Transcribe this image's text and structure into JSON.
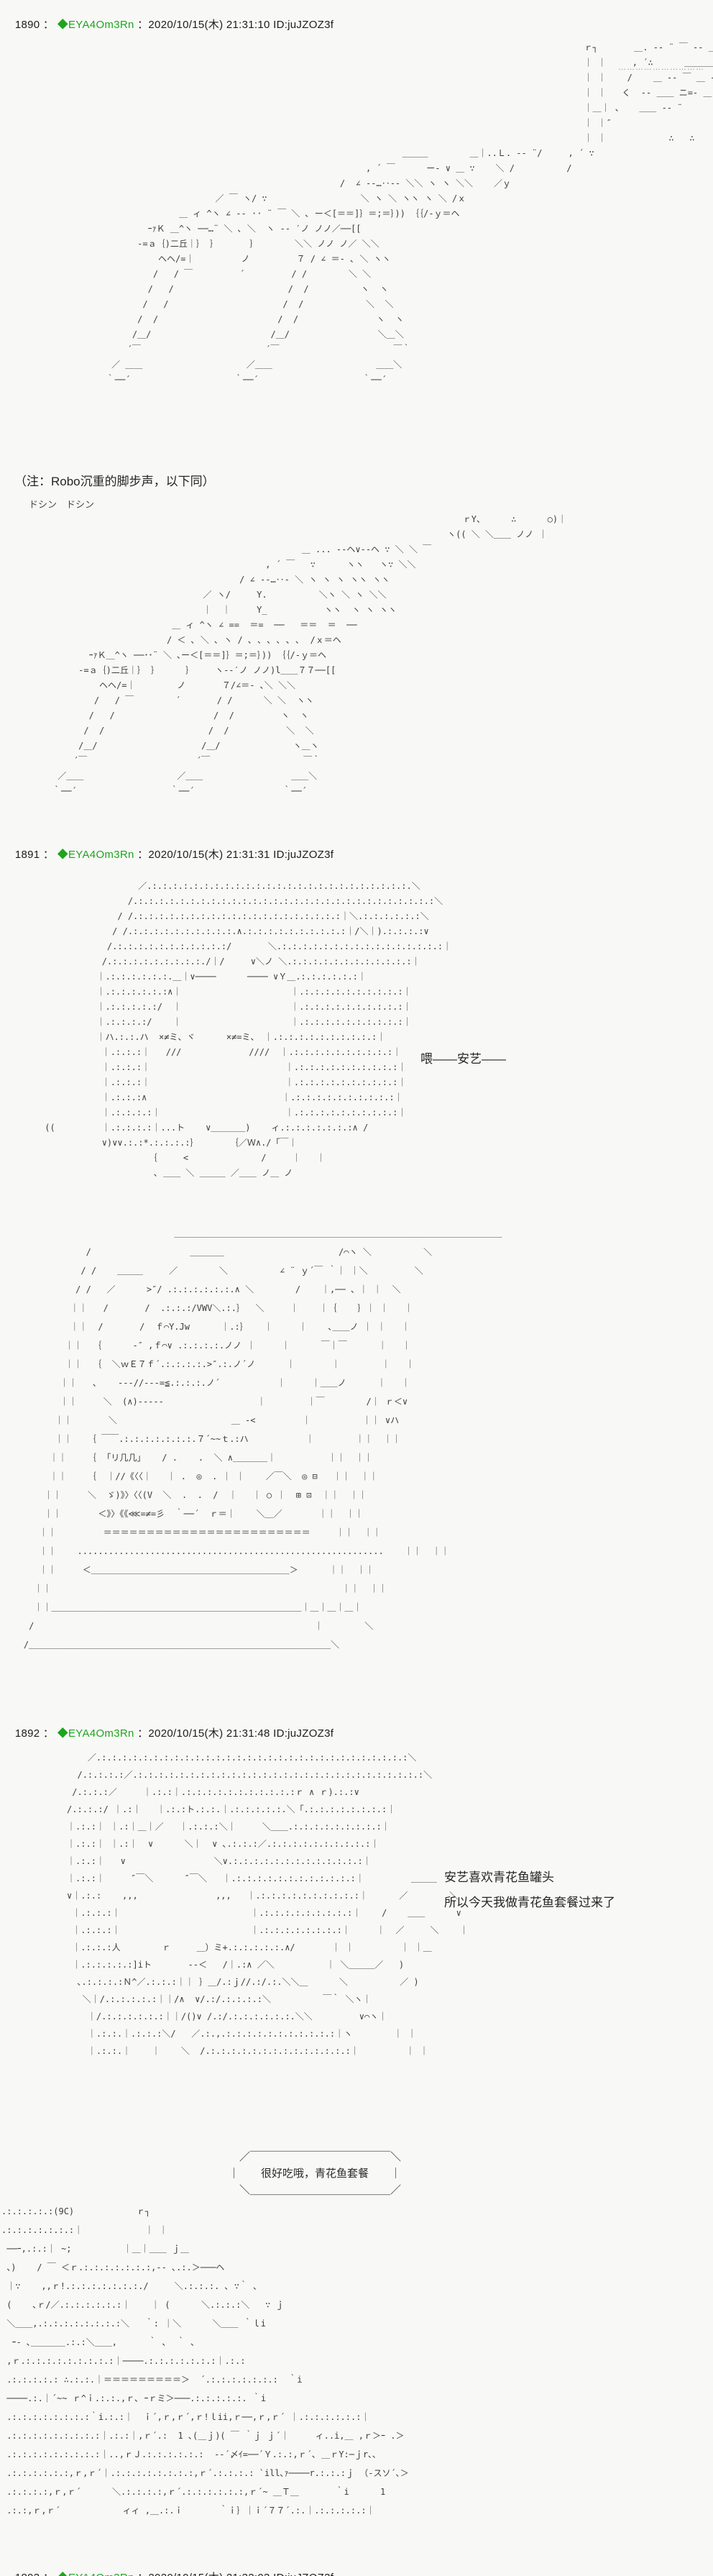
{
  "page": {
    "background": "#f8f8f6",
    "aa_color": "#3d3d3d",
    "tripcode_color": "#1ea51e"
  },
  "top_dots": "…………………………",
  "posts": [
    {
      "number": "1890",
      "sep": " ： ",
      "tripcode": "◆EYA4Om3Rn",
      "meta": " ：2020/10/15(木) 21:31:10 ID:juJZOZ3f",
      "note": "（注：Robo沉重的脚步声，以下同）",
      "sfx": "ドシン　ドシン",
      "aa_robot_1": "                                                                                                    ｒ┐       ＿. -‐ ¨ ￣ ‐- ＿\n                                                                                                    ｜ ｜     , ´∴      ＿＿＿＿\n                                                                                                    ｜ ｜    /    ＿ -‐ ￣ ＿ --\n                                                                                                    ｜ ｜   く  -- ＿＿ ニ=- ＿\n                                                                                                    ｜＿｜ 、   ＿＿ -- ¨\n                                                                                                    ｜ ｜″\n                                                                                                    ｜ ｜            ∴   ∴\n                                                                 ＿＿＿        ＿｜..Ｌ. -‐ ¨/     , ´ ∵\n                                                          , ´ ￣      ー- ∨ ＿ ∵    ＼ /          /\n                                                     /  ∠ -‐…‥‐- ＼＼ ヽ ヽ ＼＼    ／ｙ\n                             ／ ￣ ヽ/ ∵                  ＼ ヽ ＼ ヽヽ ヽ ＼ /ｘ\n                      ＿ ィ ^ヽ ∠ -‐ ·· ¨ ￣ ＼ ､ ー＜[＝＝]｝＝;＝｝)) ｛｛/‐ｙ＝ヘ\n                ｰｧＫ ＿^ヽ ──…¨ ＼ ､ ＼  ヽ -- ′ノ ノノ／──[[\n              ‐=ａ｛)二丘｜｝ ｝      ｝       ＼＼ ノノ ノ／ ＼＼\n                  ヘヘ/=｜         ノ         ７ / ∠ ＝- ､ ＼ ヽヽ\n                 /   / ￣         ´         / /        ＼ ＼\n                /   /                      /  /          ヽ  ヽ\n               /   /                      /  /            ＼  ＼\n              /  /                       /  /               ヽ  ヽ\n             /＿/                       /＿/                 ＼＿＼\n            ´￣                        ´￣                      ￣｀\n         ／ ＿＿                    ／＿＿                    ＿＿＼\n        ｀──´                    ｀──´                    ｀──´",
      "aa_robot_2": "                                                                                        ｒY、     ∴      ○)｜\n                                                                                     ヽ(( ＼ ＼＿＿ ノノ ｜\n                                                         ＿ ... -‐ヘ∨--ヘ ∵ ＼ ＼ ￣\n                                                  , ´ ￣   ∵      ヽヽ   ヽ∵ ＼＼\n                                             / ∠ -‐…‥- ＼ ヽ ヽ ヽ ヽヽ ヽヽ\n                                      ／ ヽ/     Y.          ＼ヽ ＼ ヽ ＼＼\n                                      ｜  ｜     Y_           ヽヽ  ヽ ヽ ヽヽ\n                                ＿ ィ ^ヽ ∠ ==  ＝=  ──   ＝＝  ＝  ──\n                               / ＜ ､ ＼ ､ ヽ / ､ ､ ､ ､ ､ ､  /ｘ＝ヘ\n                ｰｧＫ＿^ヽ ──･･¨ ＼ ､ー＜[＝＝]｝＝;＝｝)) ｛｛/‐ｙ＝ヘ\n              ‐=ａ｛)二丘｜｝ ｝     ｝    ヽ--′ノ ノノ)l＿＿７７──[[\n                  ヘヘ/=｜        ノ       ７/∠＝- ､＼ ＼＼\n                 /   / ￣        ´       / /      ＼ ＼  ヽヽ\n                /   /                   /  /         ヽ  ヽ\n               /  /                    /  /           ＼  ＼\n              /＿/                    /＿/              ヽ＿ヽ\n             ´￣                     ´￣                  ￣｀\n          ／＿＿                  ／＿＿                 ＿＿＼\n         ｀──´                  ｀──´                 ｀──´"
    },
    {
      "number": "1891",
      "sep": " ： ",
      "tripcode": "◆EYA4Om3Rn",
      "meta": " ：2020/10/15(木) 21:31:31 ID:juJZOZ3f",
      "dialog": "喂——安艺——",
      "aa_face": "                   ／.:.:.:.:.:.:.:.:.:.:.:.:.:.:.:.:.:.:.:.:.:.:.:.:.:.＼\n                 /.:.:.:.:.:.:.:.:.:.:.:.:.:.:.:.:.:.:.:.:.:.:.:.:.:.:.:.:.:＼\n               / /.:.:.:.:.:.:.:.:.:.:.:.:.:.:.:.:.:.:.:.:｜＼.:.:.:.:.:.:＼\n              / /.:.:.:.:.:.:.:.:.:.:.∧.:.:.:.:.:.:.:.:.:.:｜/＼｜).:.:.:.:∨\n             /.:.:.:.:.:.:.:.:.:.:.:/       ＼.:.:.:.:.:.:.:.:.:.:.:.:.:.:.:.:｜\n            /.:.:.:.:.:.:.:.:.:./｜/     ∨＼ノ ＼.:.:.:.:.:.:.:.:.:.:.:.:｜\n           ｜.:.:.:.:.:.:.＿｜∨────      ──── ∨Ｙ＿.:.:.:.:.:.:｜\n           ｜.:.:.:.:.:.:∧｜                     ｜.:.:.:.:.:.:.:.:.:.:｜\n           ｜.:.:.:.:.:/  ｜                     ｜.:.:.:.:.:.:.:.:.:.:｜\n           ｜.:.:.:.:/    ｜                     ｜.:.:.:.:.:.:.:.:.:.:｜\n           ｜ハ.:.:.ハ  ×≠ミ、ヾ      ×≠=ミ、 ｜.:.:.:.:.:.:.:.:.:.:｜\n            ｜.:.:.:｜   ///             ////  ｜.:.:.:.:.:.:.:.:.:.:｜\n            ｜.:.:.:｜                          ｜.:.:.:.:.:.:.:.:.:.:｜\n            ｜.:.:.:｜                          ｜.:.:.:.:.:.:.:.:.:.:｜\n            ｜.:.:.:∧                          ｜.:.:.:.:.:.:.:.:.:.:｜\n            ｜.:.:.:.:｜                        ｜.:.:.:.:.:.:.:.:.:.:｜\n ((         ｜.:.:.:.:｜...ト    ∨＿＿＿＿)    ィ.:.:.:.:.:.:.:∧ /\n            ∨)∨∨.:.:*.:.:.:.:｝      ｛／Ｗ∧./「￣｜\n                     ｛     <              /     ｜   ｜\n                      ､ ＿＿ ＼ ＿＿＿ ／＿＿ ノ＿ ノ",
      "aa_cockpit": "                                 ＿＿＿＿＿＿＿＿＿＿＿＿＿＿＿＿＿＿＿＿＿＿＿＿＿＿＿＿＿＿＿＿＿＿＿＿＿＿\n                /                   ＿＿＿＿                      /⌒ヽ ＼          ＼\n               / /    ＿＿＿     ／        ＼          ∠ ¨ ｙ´￣ ｀｜ ｜＼         ＼\n              / /   ／      >″/ .:.:.:.:.:.:.∧ ＼        /    ｜,── 、｜ ｜  ＼\n             ｜｜   /       /  .:.:.:/VWV＼.:.｝  ＼     ｜    ｜｛    ｝｜ ｜   ｜\n             ｜｜  /       /  ｆ⌒Y.Jw      ｜.:｝   ｜     ｜    ､＿＿ノ ｜ ｜   ｜\n            ｜｜  ｛      -″ ,ｆ⌒∨ .:.:.:.:.ノノ ｜     ｜      ￣｜￣      ｜   ｜\n            ｜｜  ｛  ＼ｗＥ７ｆ´.:.:.:.:.>″.:.ノ´ノ      ｜       ｜        ｜   ｜\n           ｜｜   ､    ---//---=≦.:.:.:.ノ´           ｜     ｜＿＿ノ      ｜   ｜\n           ｜｜     ＼  (∧)-----                  ｜        ｜￣        /｜ ｒ＜∨\n          ｜｜       ＼                      ＿ -<         ｜          ｜｜ ∨ハ\n          ｜｜   ｛ ￣￣.:.:.:.:.:.:.:.７´~~ｔ.:ハ           ｜        ｜｜  ｜｜\n         ｜｜    ｛  ｢リ几几｣    / .    .  ＼ ∧＿＿＿＿｜          ｜｜  ｜｜\n         ｜｜    ｛  ｜//《〈〈｜   ｜ .  ◎  . ｜ ｜    ／￣＼  ◎ ⊟   ｜｜  ｜｜\n        ｜｜     ＼  ゞ)》〉〈〈(V  ＼  .  .  /  ｜   ｜ ○ ｜  ⊞ ⊡  ｜｜  ｜｜\n        ｜｜       ＜》〉《《⋘=≠=彡  ｀──´  ｒ＝｜    ＼＿／       ｜｜  ｜｜\n       ｜｜         ＝＝＝＝＝＝＝＝＝＝＝＝＝＝＝＝＝＝＝＝＝＝＝＝     ｜｜  ｜｜\n       ｜｜    ...........................................................    ｜｜  ｜｜\n       ｜｜     ＜＿＿＿＿＿＿＿＿＿＿＿＿＿＿＿＿＿＿＿＿＿＿＿＞      ｜｜  ｜｜\n      ｜｜                                                        ｜｜  ｜｜\n      ｜｜＿＿＿＿＿＿＿＿＿＿＿＿＿＿＿＿＿＿＿＿＿＿＿＿＿＿＿＿＿｜＿｜＿｜＿｜\n     /                                                      ｜        ＼\n    /＿＿＿＿＿＿＿＿＿＿＿＿＿＿＿＿＿＿＿＿＿＿＿＿＿＿＿＿＿＿＿＿＿＿＿＼"
    },
    {
      "number": "1892",
      "sep": " ： ",
      "tripcode": "◆EYA4Om3Rn",
      "meta": " ：2020/10/15(木) 21:31:48 ID:juJZOZ3f",
      "dialog_line1": "安艺喜欢青花鱼罐头",
      "dialog_line2": "所以今天我做青花鱼套餐过来了",
      "speech_box_text": "很好吃哦，青花鱼套餐",
      "speech_box": "　／￣￣￣￣￣￣￣￣￣￣￣￣￣＼\n｜　　很好吃哦，青花鱼套餐　　｜\n　＼＿＿＿＿＿＿＿＿＿＿＿＿＿／",
      "aa_face": "             ／.:.:.:.:.:.:.:.:.:.:.:.:.:.:.:.:.:.:.:.:.:.:.:.:.:.:.:.:.:.:＼\n           /.:.:.:.:／.:.:.:.:.:.:.:.:.:.:.:.:.:.:.:.:.:.:.:.:.:.:.:.:.:.:.:.:＼\n          /.:.:.:／     ｜.:.:｜.:.:.:.:.:.:.:.:.:.:.:ｒ ∧ ｒ).:.:∨\n         /.:.:.:/ ｜.:｜   ｜.:.:ト.:.:.｜.:.:.:.:.:.＼「.:.:.:.:.:.:.:.:｜\n         ｜.:.:｜ ｜.:｜＿｜／   ｜.:.:.:＼｜     ＼＿＿.:.:.:.:.:.:.:.:.:｜\n         ｜.:.:｜ ｜.:｜  ∨      ＼｜  ∨ ､.:.:.:／.:.:.:.:.:.:.:.:.:.:｜\n         ｜.:.:｜   ∨                 ＼∨.:.:.:.:.:.:.:.:.:.:.:.:.:｜\n         ｜.:.:｜     ″￣＼      ″￣＼   ｜.:.:.:.:.:.:.:.:.:.:.:.:｜         ＿＿＿\n         ∨｜.:.:    ,,,               ,,,   ｜.:.:.:.:.:.:.:.:.:.:｜      ／        ＼\n          ｜.:.:.:｜                         ｜.:.:.:.:.:.:.:.:.:｜    /    ＿＿      ∨\n          ｜.:.:.:｜                         ｜.:.:.:.:.:.:.:.:｜     ｜  ／     ＼    ｜\n          ｜.:.:.:人        ｒ     ＿）ミ+.:.:.:.:.:.∧/       ｜ ｜         ｜ ｜＿\n          ｜.:.:.:.:.:]iト       --＜   /｜.:∧ ／＼          ｜ ＼＿＿＿／   )\n           ､.:.:.:.:Ｎ^／.:.:.:｜｜ ｝＿/.:ｊ//.:/.:.＼＼＿      ＼          ／ )\n            ＼｜/.:.:.:.:.:｜｜/∧  ∨/.:/.:.:.:.:＼          ￣｀ ＼ヽ｜\n             ｜/.:.:.:.:.:.:｜｜/()∨ /.:/.:.:.:.:.:.:.＼＼         ∨⌒ヽ｜\n             ｜.:.:.｜.:.:.:＼/   ／.:.,.:.:.:.:.:.:.:.:.:.:.:｜ヽ        ｜ ｜\n             ｜.:.:.｜    ｜    ＼  /.:.:.:.:.:.:.:.:.:.:.:.:.:.:｜         ｜ ｜",
      "aa_mecha": ".:.:.:.:.:(9C)            ｒ┐\n.:.:.:.:.:.:.:｜            ｜ ｜\n ──ｰ,.:.:｜ ~;          ｜＿｜＿＿ ｊ＿\n 、)    / ￣ ＜ｒ.:.:.:.:.:.:.:,-- ､.:.＞───ヘ\n ｜∵    ,,ｒ!.:.:.:.:.:.:.:./     ＼.:.:.:. ､ ∵｀ ､\n (    ､ｒ/／.:.:.:.:.:.:｜    ｜ (      ＼.:.:.:＼   ∵ ｊ\n ＼＿＿,.:.:.:.:.:.:.:.:＼   ｀: ｜＼      ＼＿＿ ｀ｌi\n  ｰ- ､＿＿＿＿.:.:＼＿＿,      ｀ ､  ｀ ､\n ,ｒ.:.:.:.:.:.:.:.:.:｜────.:.:.:.:.:.:.:｜.:.:\n .:.:.:.:.: ∴.:.:.｜＝＝＝＝＝＝＝＝＝＞  ´.:.:.:.:.:.:.:  ｀i\n ────.:.｜´~~ ｒ^ｉ.:.:.,ｒ､ ｰｒミ＞───.:.:.:.:.:. ｀i\n .:.:.:.:.:.:.:.:｀i.:.:｜  ｉ´,ｒ,ｒ´,ｒ!ｌii,ｒ──,ｒ,ｒ´ ｜.:.:.:.:.:.:｜\n .:.:.:.:.:.:.:.:.:｜.:.:｜,ｒ´.:  1 ､(＿ｊ)( ￣ ｀ｊ ｊ´｜     ィ..i,＿ ,ｒ＞ｰ .＞\n .:.:.:.:.:.:.:.:.:｜..,ｒＪ.:.:.:.:.:.:  --´〆ｲ=──´Ｙ.:.:,ｒ´､ ＿ｒY:─ｊr､､\n .:.:.:.:.:.:,ｒ,ｒ´｜.:.:.:.:.:.:.:.:,ｒ´.:.:.:.: `ill､ｧ────r.:.:.:ｊ （-スソ´､＞\n .:.:.:.:,ｒ,ｒ´      ＼.:.:.:.:,ｒ´.:.:.:.:.:.:,ｒ´~ ＿Ｔ＿       ｀i      1\n .:.:,ｒ,ｒ´            ィィ ,＿.:.ｉ       ｀ｉ｝｜ｉ´７７´.:.｜.:.:.:.:.:｜"
    },
    {
      "number": "1893",
      "sep": " ： ",
      "tripcode": "◆EYA4Om3Rn",
      "meta": " ：2020/10/15(木) 21:32:03 ID:juJZOZ3f"
    }
  ]
}
